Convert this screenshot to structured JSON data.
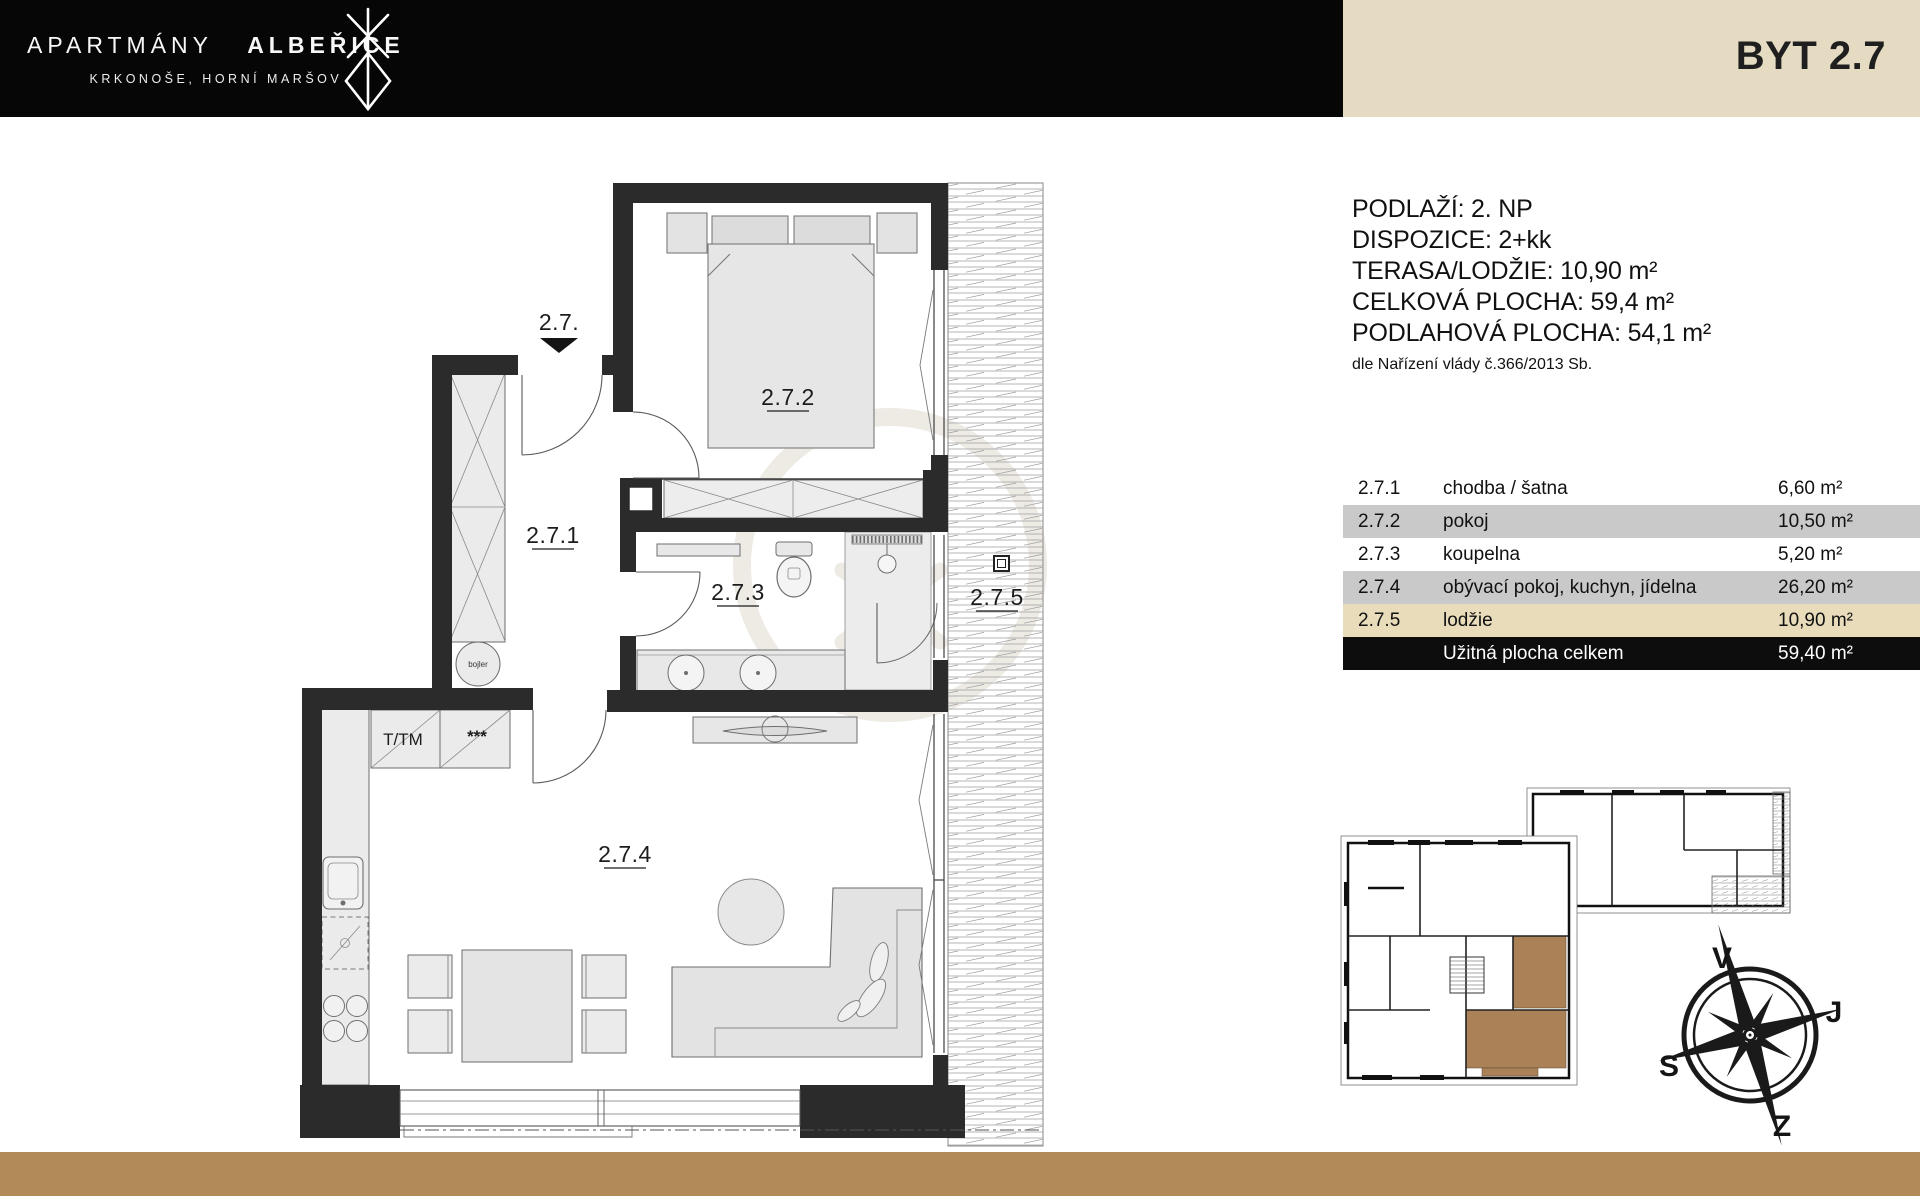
{
  "header": {
    "brand_top_light": "APARTMÁNY",
    "brand_top_bold": "ALBEŘICE",
    "brand_sub": "KRKONOŠE, HORNÍ MARŠOV",
    "unit_title": "BYT 2.7"
  },
  "info": {
    "lines": [
      "PODLAŽÍ: 2. NP",
      "DISPOZICE: 2+kk",
      "TERASA/LODŽIE: 10,90 m²",
      "CELKOVÁ PLOCHA: 59,4 m²",
      "PODLAHOVÁ PLOCHA: 54,1 m²"
    ],
    "note": "dle Nařízení vlády č.366/2013 Sb."
  },
  "legend": {
    "rows": [
      {
        "num": "2.7.1",
        "name": "chodba / šatna",
        "area": "6,60 m²"
      },
      {
        "num": "2.7.2",
        "name": "pokoj",
        "area": "10,50 m²"
      },
      {
        "num": "2.7.3",
        "name": "koupelna",
        "area": "5,20 m²"
      },
      {
        "num": "2.7.4",
        "name": "obývací pokoj, kuchyn, jídelna",
        "area": "26,20 m²"
      },
      {
        "num": "2.7.5",
        "name": "lodžie",
        "area": "10,90 m²"
      }
    ],
    "total": {
      "label": "Užitná plocha celkem",
      "area": "59,40 m²"
    }
  },
  "plan": {
    "entrance_label": "2.7.",
    "room_labels": {
      "hall": "2.7.1",
      "bedroom": "2.7.2",
      "bathroom": "2.7.3",
      "living": "2.7.4",
      "loggia": "2.7.5"
    },
    "annotations": {
      "boiler": "bojler",
      "cabinet1": "T/TM",
      "cabinet2": "***"
    }
  },
  "compass": {
    "top": "V",
    "right": "J",
    "left": "S",
    "bottom": "Z"
  },
  "colors": {
    "header_black": "#060606",
    "header_beige": "#e4dbc2",
    "footer_brown": "#b18a58",
    "row_gray": "#c9c9c9",
    "row_beige": "#e9dcbb",
    "total_black": "#0d0d0d",
    "unit_highlight": "#ab8157",
    "wall": "#2b2b2b"
  }
}
